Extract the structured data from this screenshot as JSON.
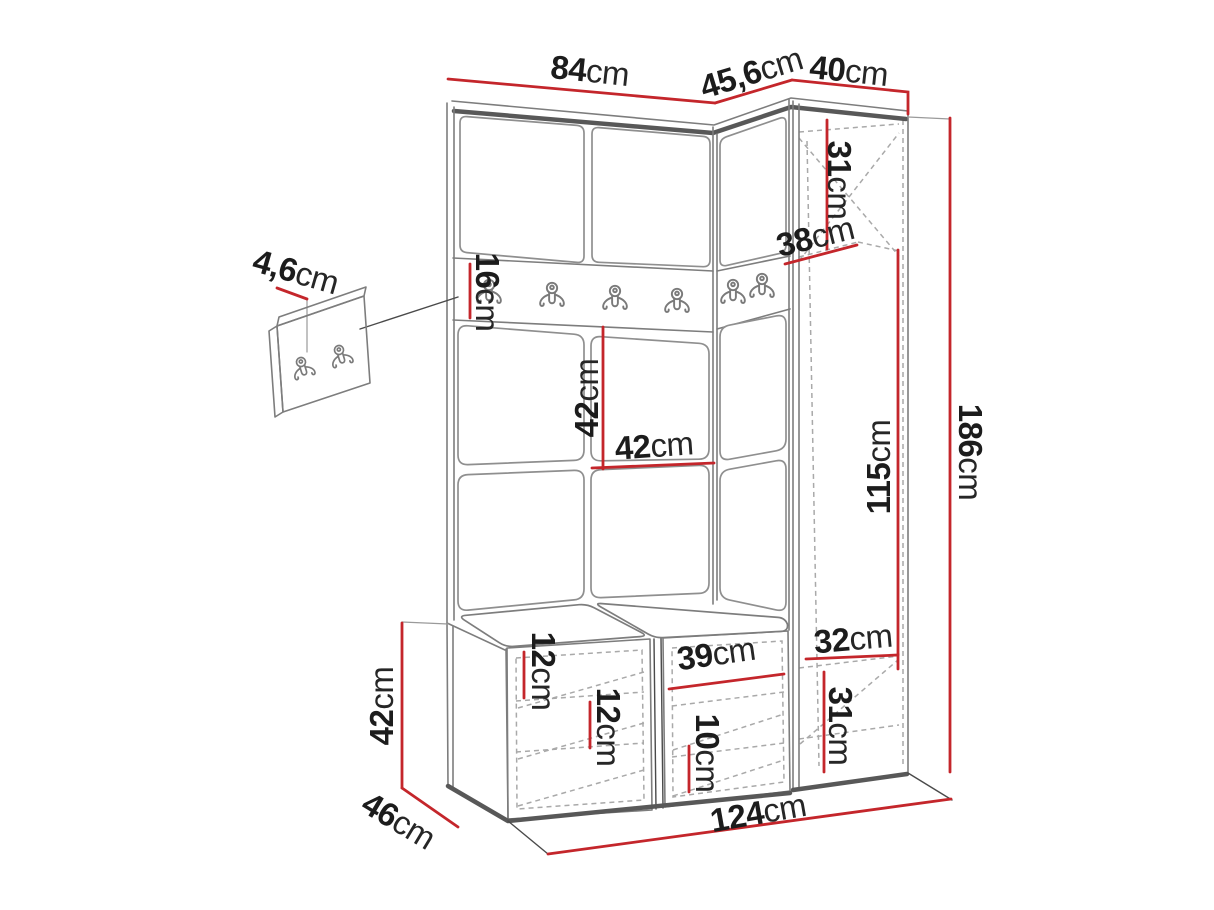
{
  "figure": {
    "kind": "hallway furniture set dimension drawing"
  },
  "colors": {
    "dimension": "#c4262b",
    "outline": "#7d7d7d",
    "edge": "#585858",
    "dashed": "#a9a9a9",
    "text": "#1c1c1c",
    "background": "#ffffff"
  },
  "dims": {
    "w84": {
      "num": "84",
      "unit": "cm"
    },
    "w456": {
      "num": "45,6",
      "unit": "cm"
    },
    "w40": {
      "num": "40",
      "unit": "cm"
    },
    "h31top": {
      "num": "31",
      "unit": "cm"
    },
    "d38": {
      "num": "38",
      "unit": "cm"
    },
    "h16": {
      "num": "16",
      "unit": "cm"
    },
    "t46": {
      "num": "4,6",
      "unit": "cm"
    },
    "h42": {
      "num": "42",
      "unit": "cm"
    },
    "w42": {
      "num": "42",
      "unit": "cm"
    },
    "h115": {
      "num": "115",
      "unit": "cm"
    },
    "h186": {
      "num": "186",
      "unit": "cm"
    },
    "w32": {
      "num": "32",
      "unit": "cm"
    },
    "h31bottom": {
      "num": "31",
      "unit": "cm"
    },
    "w39": {
      "num": "39",
      "unit": "cm"
    },
    "h12a": {
      "num": "12",
      "unit": "cm"
    },
    "h12b": {
      "num": "12",
      "unit": "cm"
    },
    "h10": {
      "num": "10",
      "unit": "cm"
    },
    "h42bench": {
      "num": "42",
      "unit": "cm"
    },
    "d46": {
      "num": "46",
      "unit": "cm"
    },
    "w124": {
      "num": "124",
      "unit": "cm"
    }
  }
}
